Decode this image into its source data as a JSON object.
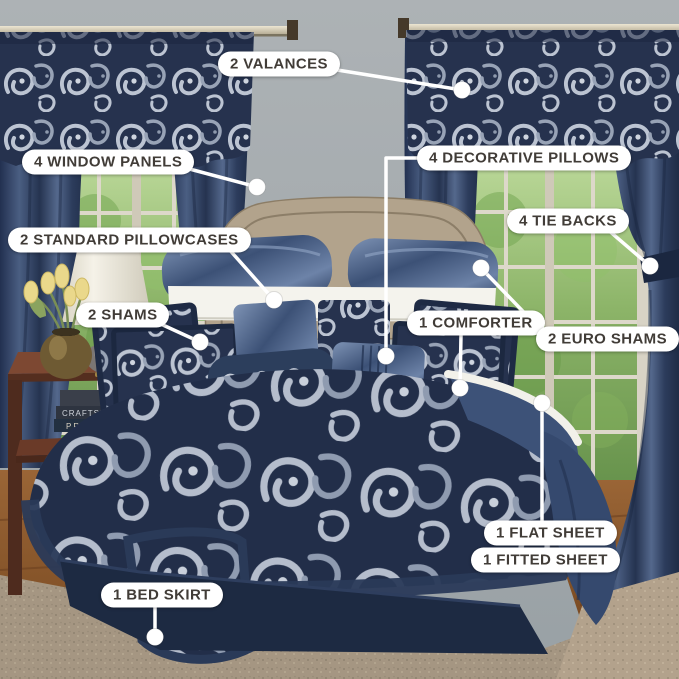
{
  "image_type": "annotated bedding-set product photo",
  "scene": {
    "description": "Navy paisley jacquard comforter bedroom set with curtains and windows",
    "books": [
      "CRAFTSMAN",
      "PREPPY"
    ]
  },
  "colors": {
    "label_bg": "#ffffff",
    "label_text": "#413c37",
    "connector": "#ffffff",
    "navy_curtain": "#2e4163",
    "navy_bedding": "#26324e",
    "paisley_silver": "#bcc4d2",
    "wall_gray": "#a6acaf",
    "headboard_tan": "#b2a38c",
    "wood_floor": "#8a5730",
    "carpet_tan": "#a59682"
  },
  "callouts": [
    {
      "id": "valances",
      "text": "2 VALANCES",
      "pill": [
        218,
        64
      ],
      "line": [
        [
          331,
          69
        ],
        [
          462,
          90
        ]
      ],
      "dot": [
        462,
        90
      ]
    },
    {
      "id": "window-panels",
      "text": "4 WINDOW PANELS",
      "pill": [
        22,
        162
      ],
      "line": [
        [
          182,
          167
        ],
        [
          257,
          187
        ]
      ],
      "dot": [
        257,
        187
      ]
    },
    {
      "id": "decorative-pillows",
      "text": "4 DECORATIVE PILLOWS",
      "pill": [
        417,
        158
      ],
      "line": [
        [
          419,
          158
        ],
        [
          386,
          158
        ],
        [
          386,
          356
        ]
      ],
      "dot": [
        386,
        356
      ]
    },
    {
      "id": "standard-pillowcases",
      "text": "2 STANDARD PILLOWCASES",
      "pill": [
        8,
        240
      ],
      "line": [
        [
          227,
          247
        ],
        [
          274,
          300
        ]
      ],
      "dot": [
        274,
        300
      ]
    },
    {
      "id": "tie-backs",
      "text": "4 TIE BACKS",
      "pill": [
        507,
        221
      ],
      "line": [
        [
          607,
          229
        ],
        [
          650,
          266
        ]
      ],
      "dot": [
        650,
        266
      ]
    },
    {
      "id": "shams",
      "text": "2 SHAMS",
      "pill": [
        76,
        315
      ],
      "line": [
        [
          152,
          320
        ],
        [
          200,
          342
        ]
      ],
      "dot": [
        200,
        342
      ]
    },
    {
      "id": "comforter",
      "text": "1 COMFORTER",
      "pill": [
        407,
        323
      ],
      "line": [
        [
          461,
          335
        ],
        [
          460,
          388
        ]
      ],
      "dot": [
        460,
        388
      ]
    },
    {
      "id": "euro-shams",
      "text": "2 EURO SHAMS",
      "pill": [
        536,
        339
      ],
      "line": [
        [
          541,
          330
        ],
        [
          481,
          268
        ]
      ],
      "dot": [
        481,
        268
      ]
    },
    {
      "id": "flat-sheet",
      "text": "1 FLAT SHEET",
      "pill": [
        484,
        533
      ],
      "line": [
        [
          542,
          521
        ],
        [
          542,
          403
        ]
      ],
      "dot": [
        542,
        403
      ]
    },
    {
      "id": "fitted-sheet",
      "text": "1 FITTED SHEET",
      "pill": [
        471,
        560
      ],
      "line": null,
      "dot": null
    },
    {
      "id": "bed-skirt",
      "text": "1 BED SKIRT",
      "pill": [
        101,
        595
      ],
      "line": [
        [
          155,
          607
        ],
        [
          155,
          637
        ]
      ],
      "dot": [
        155,
        637
      ]
    }
  ]
}
